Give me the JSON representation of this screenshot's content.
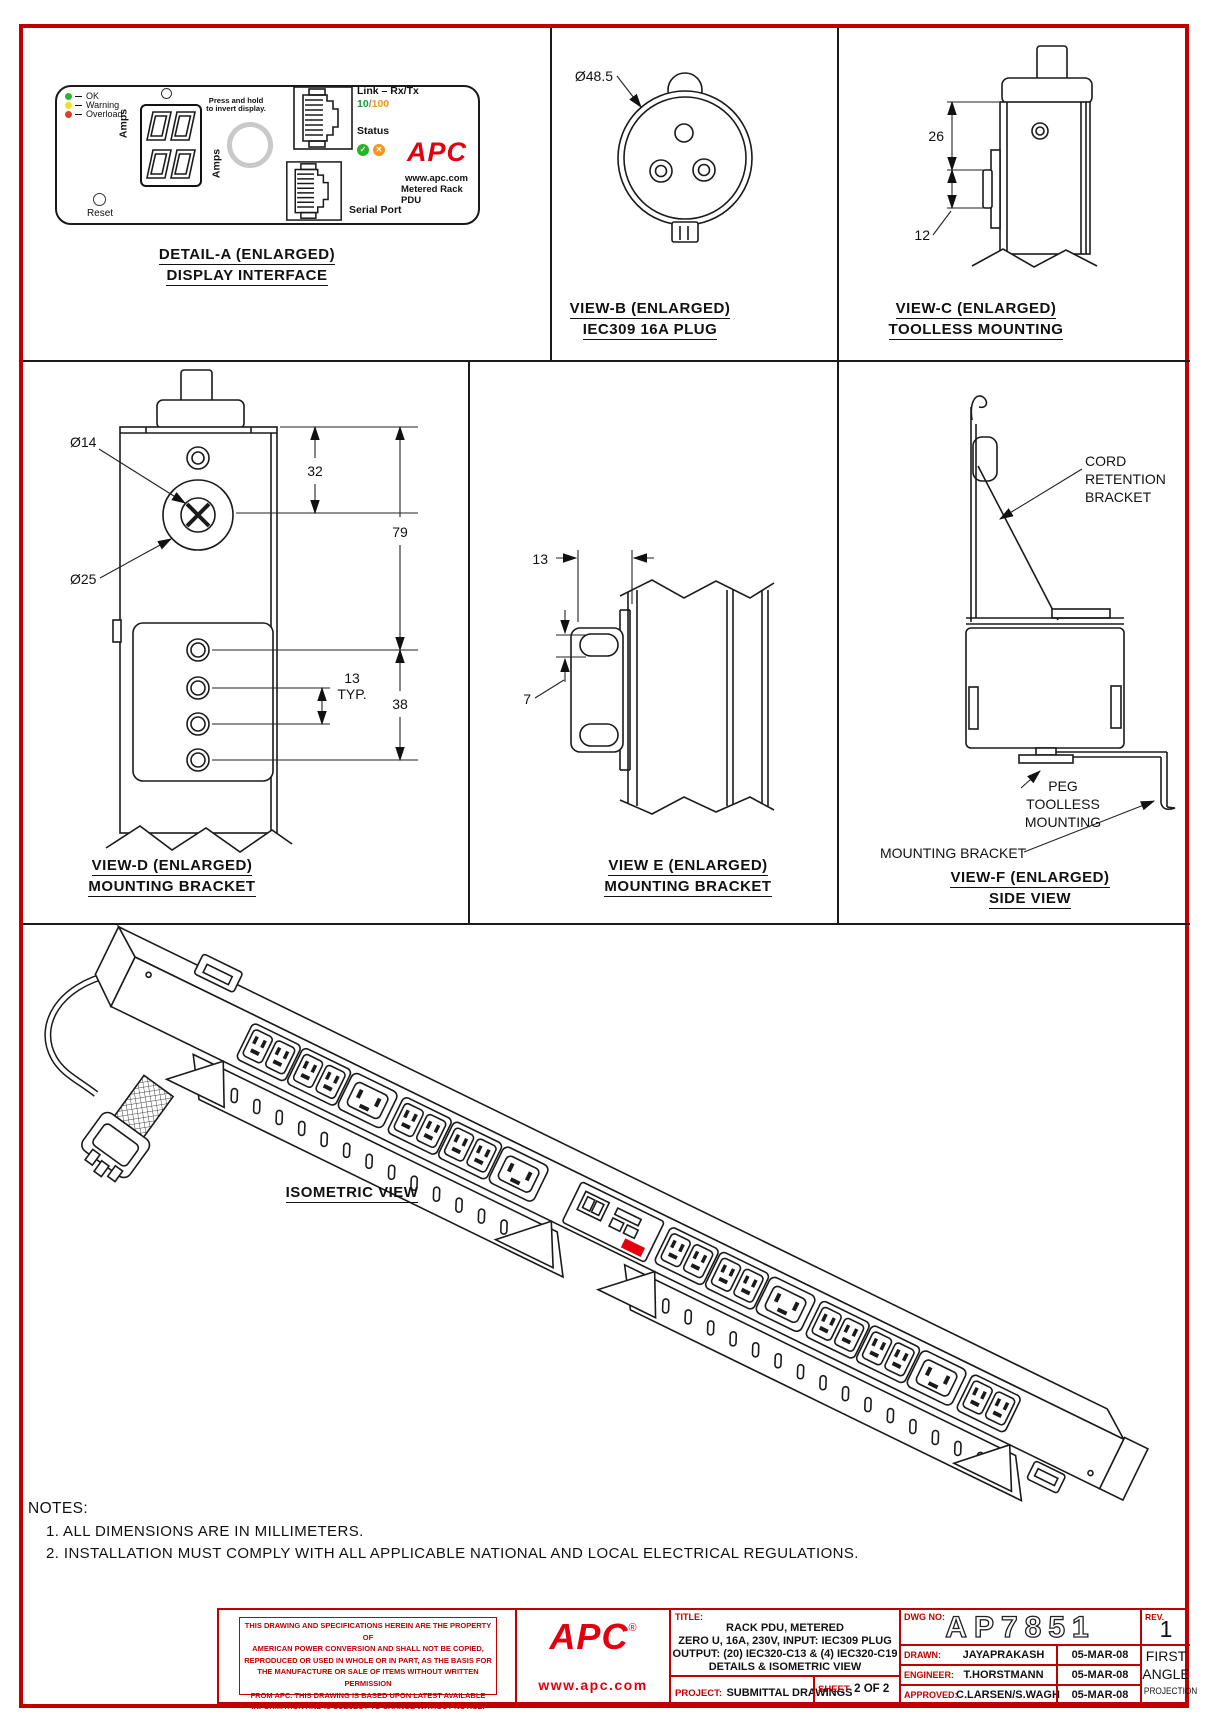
{
  "page": {
    "accent_red": "#c00000",
    "apc_red": "#e2000f",
    "line_black": "#1a1a1a"
  },
  "detail_a": {
    "title_line1": "DETAIL-A (ENLARGED)",
    "title_line2": "DISPLAY INTERFACE",
    "legend": [
      {
        "label": "OK",
        "color": "#2db52d"
      },
      {
        "label": "Warning",
        "color": "#f2e21c"
      },
      {
        "label": "Overload",
        "color": "#e23d28"
      }
    ],
    "amps_left": "Amps",
    "amps_right": "Amps",
    "press_hold_line1": "Press and hold",
    "press_hold_line2": "to invert display.",
    "reset_label": "Reset",
    "link_label": "Link – Rx/Tx",
    "speed_10": "10",
    "speed_sep": "/",
    "speed_100": "100",
    "status_label": "Status",
    "status_check": "✓",
    "status_x": "✕",
    "serial_label": "Serial Port",
    "apc_logo": "APC",
    "apc_url": "www.apc.com",
    "apc_product": "Metered Rack PDU"
  },
  "view_b": {
    "dim_diameter": "Ø48.5",
    "title_line1": "VIEW-B (ENLARGED)",
    "title_line2": "IEC309 16A PLUG"
  },
  "view_c": {
    "dim_26": "26",
    "dim_12": "12",
    "title_line1": "VIEW-C (ENLARGED)",
    "title_line2": "TOOLLESS MOUNTING"
  },
  "view_d": {
    "dim_d14": "Ø14",
    "dim_d25": "Ø25",
    "dim_32": "32",
    "dim_79": "79",
    "dim_13": "13",
    "dim_typ": "TYP.",
    "dim_38": "38",
    "title_line1": "VIEW-D (ENLARGED)",
    "title_line2": "MOUNTING BRACKET"
  },
  "view_e": {
    "dim_13": "13",
    "dim_7": "7",
    "title_line1": "VIEW E (ENLARGED)",
    "title_line2": "MOUNTING BRACKET"
  },
  "view_f": {
    "cord_label_line1": "CORD",
    "cord_label_line2": "RETENTION",
    "cord_label_line3": "BRACKET",
    "peg_label_line1": "PEG",
    "peg_label_line2": "TOOLLESS",
    "peg_label_line3": "MOUNTING",
    "mounting_bracket_label": "MOUNTING BRACKET",
    "title_line1": "VIEW-F (ENLARGED)",
    "title_line2": "SIDE VIEW"
  },
  "isometric": {
    "title": "ISOMETRIC VIEW"
  },
  "notes": {
    "heading": "NOTES:",
    "item1": "1. ALL DIMENSIONS ARE IN MILLIMETERS.",
    "item2": "2. INSTALLATION MUST COMPLY WITH ALL APPLICABLE NATIONAL AND LOCAL ELECTRICAL REGULATIONS."
  },
  "title_block": {
    "disclaimer_line1": "THIS DRAWING AND SPECIFICATIONS HEREIN ARE THE PROPERTY OF",
    "disclaimer_line2": "AMERICAN POWER CONVERSION AND SHALL NOT BE COPIED,",
    "disclaimer_line3": "REPRODUCED OR USED IN WHOLE OR IN PART, AS THE BASIS FOR",
    "disclaimer_line4": "THE MANUFACTURE OR SALE OF ITEMS WITHOUT WRITTEN PERMISSION",
    "disclaimer_line5": "FROM APC. THIS DRAWING IS BASED UPON LATEST AVAILABLE",
    "disclaimer_line6": "INFORMATION AND IS SUBJECT TO CHANGE WITHOUT NOTICE.",
    "apc_logo": "APC",
    "apc_reg": "®",
    "apc_url": "www.apc.com",
    "title_label": "TITLE:",
    "title_line1": "RACK PDU, METERED",
    "title_line2": "ZERO U, 16A, 230V,   INPUT: IEC309 PLUG",
    "title_line3": "OUTPUT: (20) IEC320-C13 & (4) IEC320-C19",
    "title_line4": "DETAILS & ISOMETRIC VIEW",
    "project_label": "PROJECT:",
    "project_value": "SUBMITTAL DRAWINGS",
    "sheet_label": "SHEET",
    "sheet_value": "2 OF 2",
    "dwg_label": "DWG NO:",
    "dwg_value": "AP7851",
    "rev_label": "REV.",
    "rev_value": "1",
    "drawn_label": "DRAWN:",
    "drawn_name": "JAYAPRAKASH",
    "drawn_date": "05-MAR-08",
    "engineer_label": "ENGINEER:",
    "engineer_name": "T.HORSTMANN",
    "engineer_date": "05-MAR-08",
    "approved_label": "APPROVED:",
    "approved_name": "C.LARSEN/S.WAGH",
    "approved_date": "05-MAR-08",
    "projection_line1": "FIRST",
    "projection_line2": "ANGLE",
    "projection_line3": "PROJECTION"
  }
}
